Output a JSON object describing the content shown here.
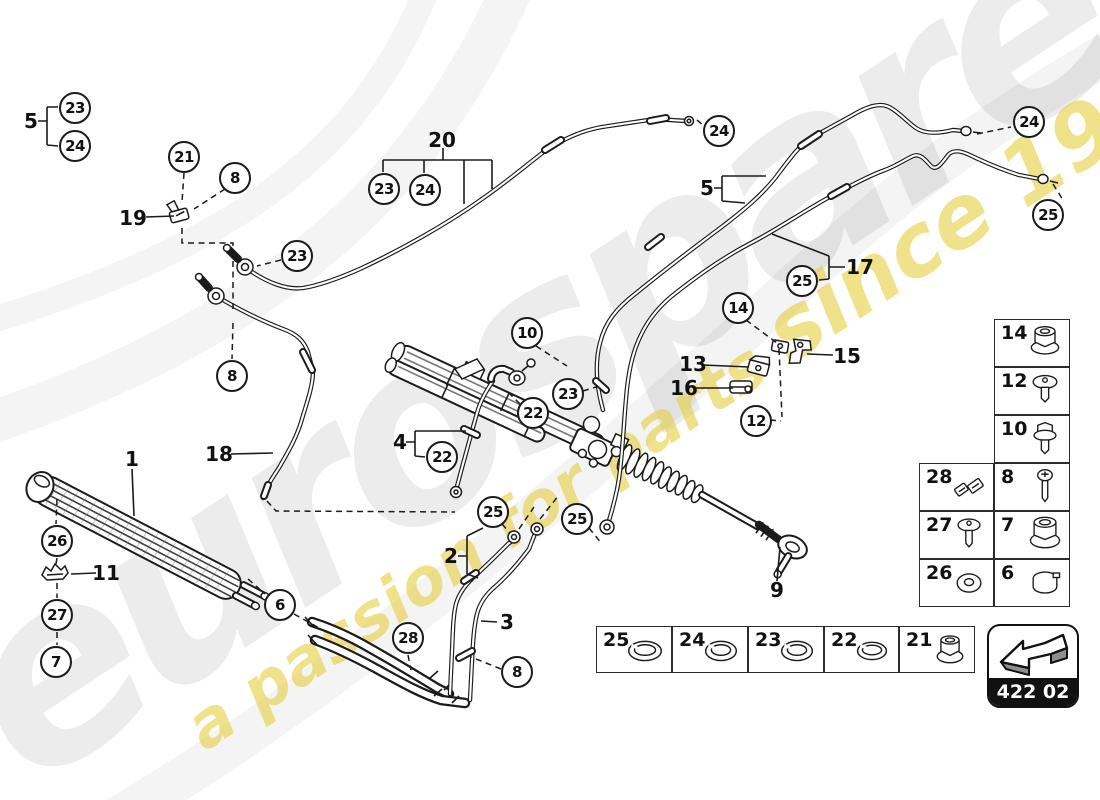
{
  "colors": {
    "line": "#1b1b1b",
    "watermark_yellow": "#e7cf45",
    "badge_bg": "#111111",
    "paper": "#ffffff"
  },
  "watermark": {
    "brand": "eurospares",
    "tagline": "a passion for parts ",
    "tagline_year": "since 1985"
  },
  "callouts": [
    {
      "label": "23"
    },
    {
      "label": "24"
    },
    {
      "label": "21"
    },
    {
      "label": "8"
    },
    {
      "label": "23"
    },
    {
      "label": "23"
    },
    {
      "label": "24"
    },
    {
      "label": "24"
    },
    {
      "label": "24"
    },
    {
      "label": "25"
    },
    {
      "label": "25"
    },
    {
      "label": "14"
    },
    {
      "label": "12"
    },
    {
      "label": "10"
    },
    {
      "label": "23"
    },
    {
      "label": "22"
    },
    {
      "label": "22"
    },
    {
      "label": "8"
    },
    {
      "label": "26"
    },
    {
      "label": "27"
    },
    {
      "label": "7"
    },
    {
      "label": "6"
    },
    {
      "label": "28"
    },
    {
      "label": "8"
    },
    {
      "label": "25"
    },
    {
      "label": "25"
    }
  ],
  "labels": [
    {
      "text": "5"
    },
    {
      "text": "19"
    },
    {
      "text": "20"
    },
    {
      "text": "1"
    },
    {
      "text": "18"
    },
    {
      "text": "11"
    },
    {
      "text": "4"
    },
    {
      "text": "2"
    },
    {
      "text": "3"
    },
    {
      "text": "5"
    },
    {
      "text": "17"
    },
    {
      "text": "15"
    },
    {
      "text": "13"
    },
    {
      "text": "16"
    },
    {
      "text": "9"
    }
  ],
  "legend": {
    "single": [
      {
        "number": "14",
        "icon": "flange-nut"
      },
      {
        "number": "12",
        "icon": "dome-screw"
      },
      {
        "number": "10",
        "icon": "flanged-bolt"
      }
    ],
    "left": [
      {
        "number": "28",
        "icon": "clip-bracket"
      },
      {
        "number": "27",
        "icon": "dome-screw"
      },
      {
        "number": "26",
        "icon": "washer"
      }
    ],
    "right": [
      {
        "number": "8",
        "icon": "pan-screw"
      },
      {
        "number": "7",
        "icon": "flange-nut"
      },
      {
        "number": "6",
        "icon": "clamp-ring"
      }
    ]
  },
  "strip": [
    {
      "number": "25",
      "icon": "seal-ring"
    },
    {
      "number": "24",
      "icon": "seal-ring"
    },
    {
      "number": "23",
      "icon": "seal-ring"
    },
    {
      "number": "22",
      "icon": "seal-ring"
    },
    {
      "number": "21",
      "icon": "flange-nut"
    }
  ],
  "badge": {
    "code": "422 02",
    "icon": "direction-arrow"
  }
}
